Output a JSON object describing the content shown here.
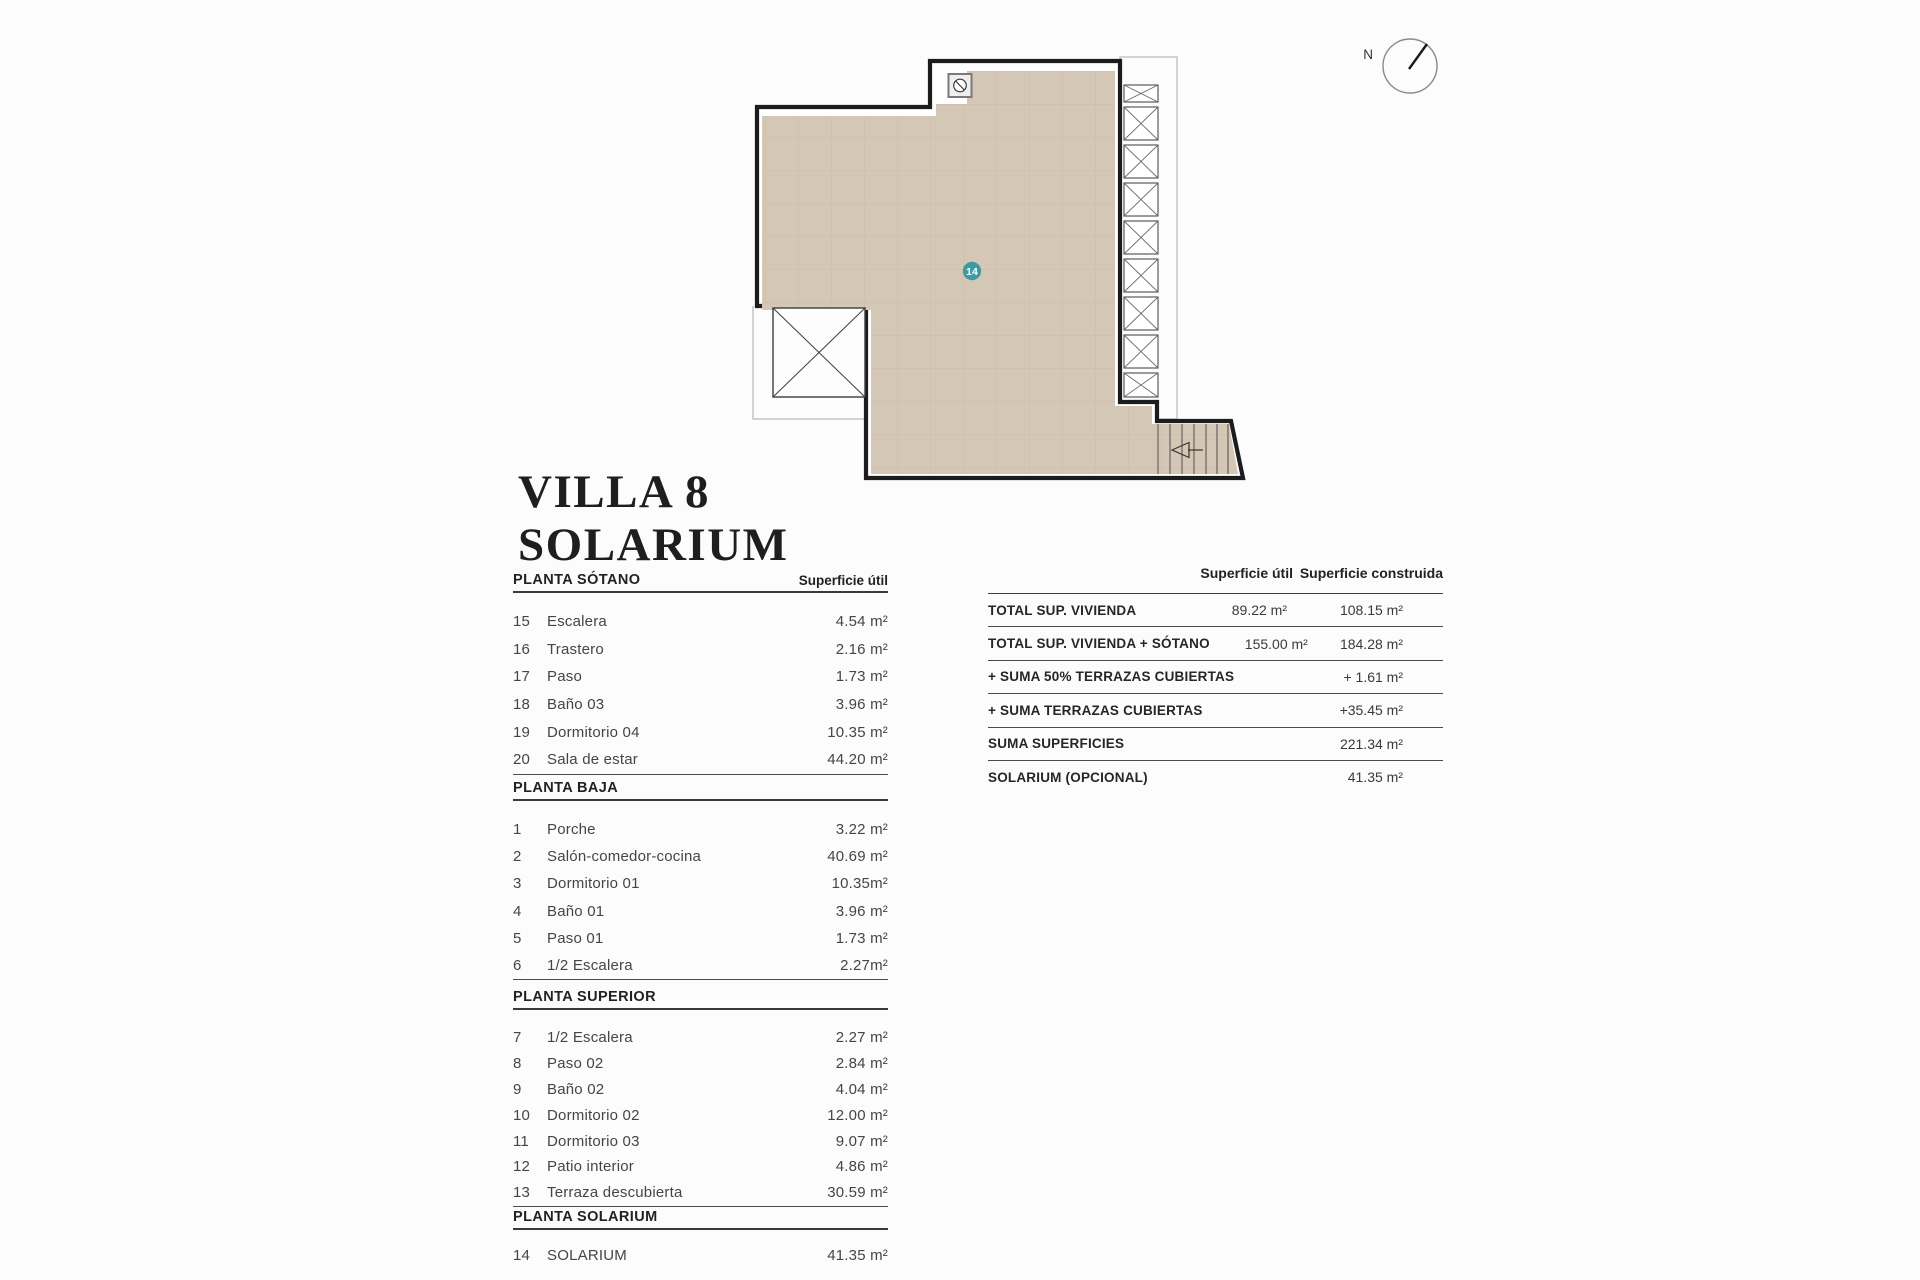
{
  "title": {
    "line1": "VILLA 8",
    "line2": "SOLARIUM"
  },
  "plan": {
    "badge_label": "14",
    "badge_color": "#3d9aa1",
    "floor_color": "#d5c7b5",
    "compass_label": "N"
  },
  "floor_table": {
    "area_header": "Superficie útil",
    "sections": [
      {
        "title": "PLANTA SÓTANO",
        "rows": [
          {
            "num": "15",
            "name": "Escalera",
            "area": "4.54 m²"
          },
          {
            "num": "16",
            "name": "Trastero",
            "area": "2.16 m²"
          },
          {
            "num": "17",
            "name": "Paso",
            "area": "1.73 m²"
          },
          {
            "num": "18",
            "name": "Baño 03",
            "area": "3.96 m²"
          },
          {
            "num": "19",
            "name": "Dormitorio 04",
            "area": "10.35 m²"
          },
          {
            "num": "20",
            "name": "Sala de estar",
            "area": "44.20 m²"
          }
        ]
      },
      {
        "title": "PLANTA BAJA",
        "rows": [
          {
            "num": "1",
            "name": "Porche",
            "area": "3.22 m²"
          },
          {
            "num": "2",
            "name": "Salón-comedor-cocina",
            "area": "40.69 m²"
          },
          {
            "num": "3",
            "name": "Dormitorio 01",
            "area": "10.35m²"
          },
          {
            "num": "4",
            "name": "Baño 01",
            "area": "3.96 m²"
          },
          {
            "num": "5",
            "name": "Paso 01",
            "area": "1.73 m²"
          },
          {
            "num": "6",
            "name": "1/2 Escalera",
            "area": "2.27m²"
          }
        ]
      },
      {
        "title": "PLANTA SUPERIOR",
        "rows": [
          {
            "num": "7",
            "name": "1/2 Escalera",
            "area": "2.27 m²"
          },
          {
            "num": "8",
            "name": "Paso 02",
            "area": "2.84 m²"
          },
          {
            "num": "9",
            "name": "Baño 02",
            "area": "4.04 m²"
          },
          {
            "num": "10",
            "name": "Dormitorio 02",
            "area": "12.00 m²"
          },
          {
            "num": "11",
            "name": "Dormitorio 03",
            "area": "9.07 m²"
          },
          {
            "num": "12",
            "name": "Patio interior",
            "area": "4.86 m²"
          },
          {
            "num": "13",
            "name": "Terraza descubierta",
            "area": "30.59 m²"
          }
        ]
      },
      {
        "title": "PLANTA SOLARIUM",
        "rows": [
          {
            "num": "14",
            "name": "SOLARIUM",
            "area": "41.35 m²"
          }
        ]
      }
    ]
  },
  "summary_table": {
    "headers": {
      "util": "Superficie útil",
      "built": "Superficie construida"
    },
    "rows": [
      {
        "label": "TOTAL SUP. VIVIENDA",
        "util": "89.22 m²",
        "built": "108.15 m²"
      },
      {
        "label": "TOTAL SUP. VIVIENDA + SÓTANO",
        "util": "155.00 m²",
        "built": "184.28 m²"
      },
      {
        "label": "+ SUMA 50% TERRAZAS CUBIERTAS",
        "util": "",
        "built": "+ 1.61 m²"
      },
      {
        "label": "+ SUMA TERRAZAS CUBIERTAS",
        "util": "",
        "built": "+35.45 m²"
      },
      {
        "label": "SUMA SUPERFICIES",
        "util": "",
        "built": "221.34 m²"
      },
      {
        "label": "SOLARIUM (OPCIONAL)",
        "util": "",
        "built": "41.35 m²"
      }
    ]
  }
}
